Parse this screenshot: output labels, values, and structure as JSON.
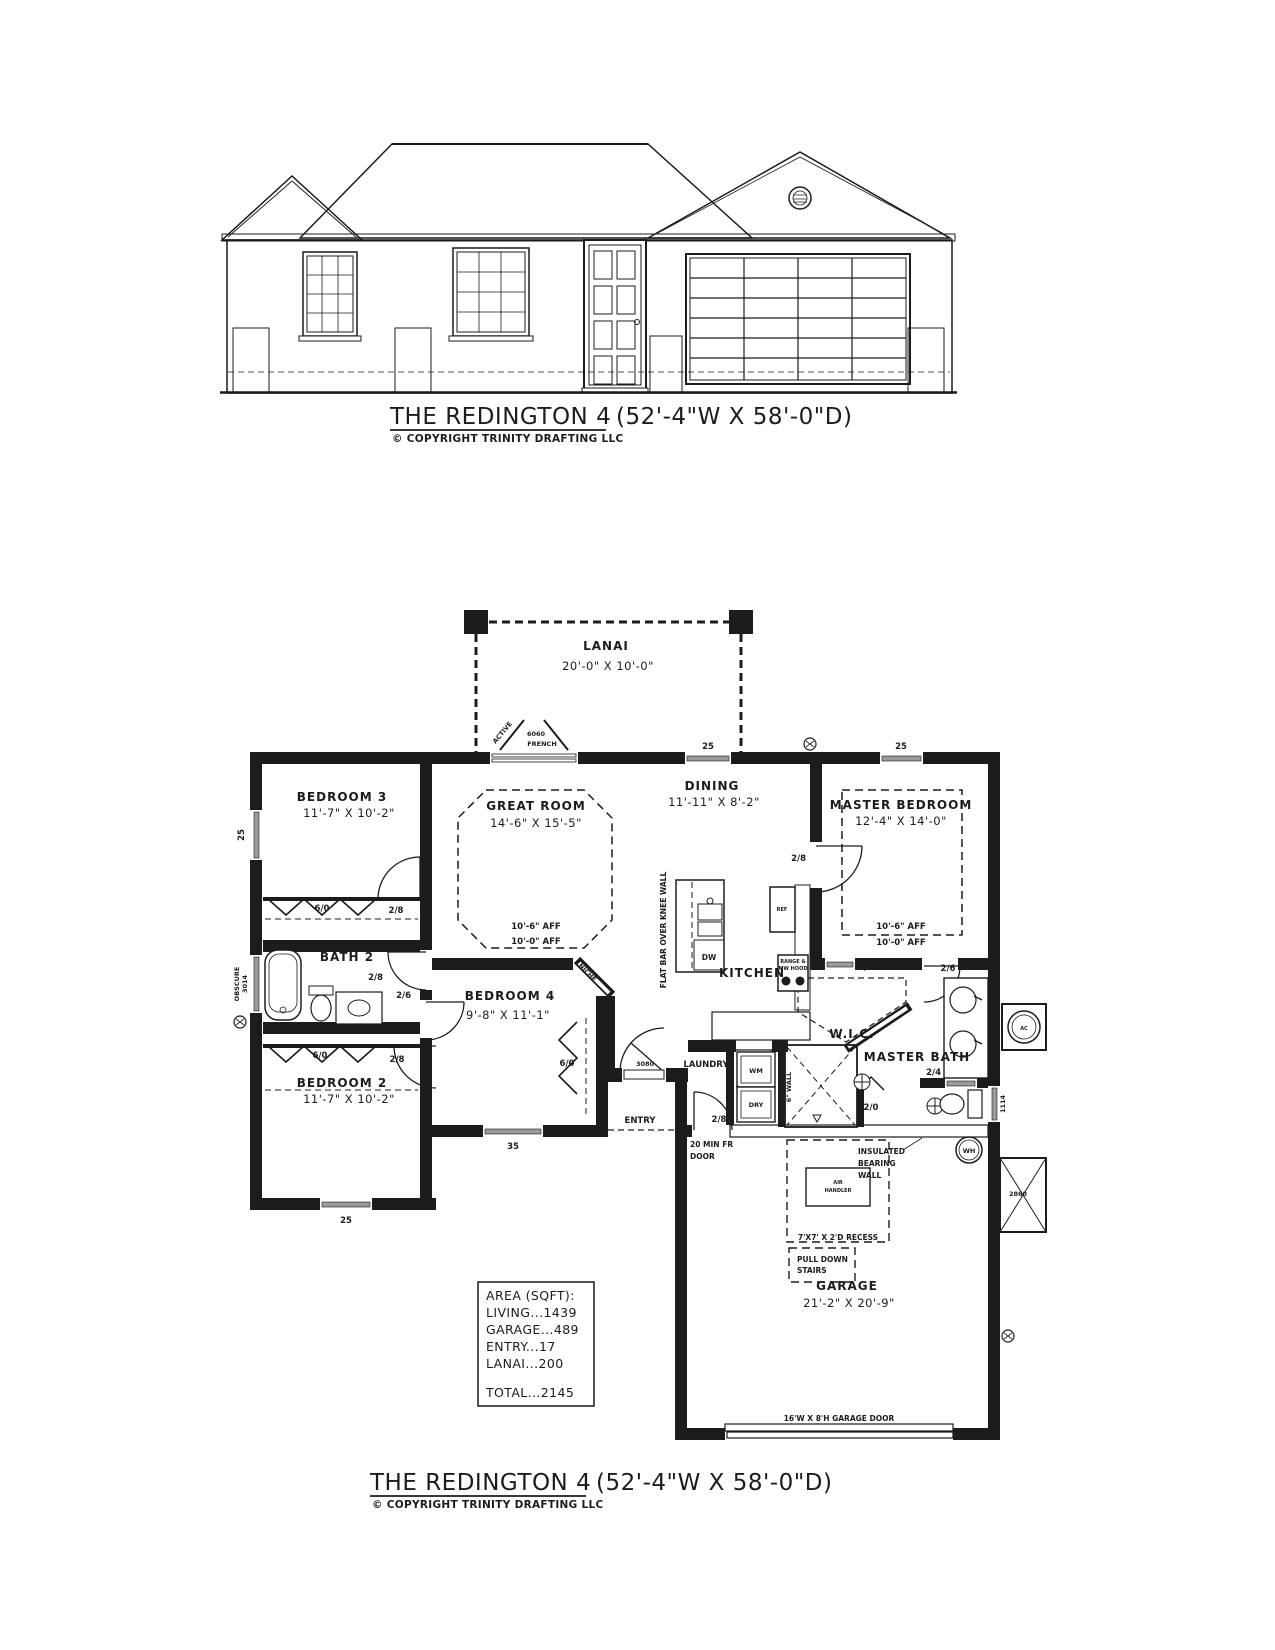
{
  "document": {
    "top_title": "THE REDINGTON 4",
    "top_title_dims": "(52'-4\"W X 58'-0\"D)",
    "bottom_title": "THE REDINGTON 4",
    "bottom_title_dims": "(52'-4\"W X 58'-0\"D)",
    "copyright": "© COPYRIGHT TRINITY DRAFTING LLC"
  },
  "rooms": {
    "lanai": {
      "name": "LANAI",
      "dims": "20'-0\" X 10'-0\""
    },
    "great_room": {
      "name": "GREAT ROOM",
      "dims": "14'-6\" X 15'-5\""
    },
    "dining": {
      "name": "DINING",
      "dims": "11'-11\" X 8'-2\""
    },
    "master_bedroom": {
      "name": "MASTER BEDROOM",
      "dims": "12'-4\" X 14'-0\""
    },
    "bedroom3": {
      "name": "BEDROOM 3",
      "dims": "11'-7\" X 10'-2\""
    },
    "bedroom2": {
      "name": "BEDROOM 2",
      "dims": "11'-7\" X 10'-2\""
    },
    "bedroom4": {
      "name": "BEDROOM 4",
      "dims": "9'-8\" X 11'-1\""
    },
    "kitchen": {
      "name": "KITCHEN"
    },
    "bath2": {
      "name": "BATH 2"
    },
    "laundry": {
      "name": "LAUNDRY"
    },
    "wic": {
      "name": "W.I.C."
    },
    "master_bath": {
      "name": "MASTER BATH"
    },
    "entry": {
      "name": "ENTRY"
    },
    "garage": {
      "name": "GARAGE",
      "dims": "21'-2\" X 20'-9\""
    }
  },
  "ceiling": {
    "aff_upper": "10'-6\" AFF",
    "aff_lower": "10'-0\" AFF"
  },
  "labels": {
    "active": "ACTIVE",
    "french_size": "6060",
    "french": "FRENCH",
    "win_25": "25",
    "win_35": "35",
    "win_2860": "2860",
    "win_1114": "1114",
    "win_obscure": "OBSCURE",
    "win_3014": "3014",
    "door_28": "2/8",
    "door_26": "2/6",
    "door_24": "2/4",
    "door_20": "2/0",
    "door_3080": "3080",
    "closet_60": "6/0",
    "niche": "NICHE",
    "flat_bar": "FLAT BAR OVER KNEE WALL",
    "six_wall": "6\" WALL",
    "fire_door_line1": "20 MIN FR",
    "fire_door_line2": "DOOR",
    "insulated_line1": "INSULATED",
    "insulated_line2": "BEARING",
    "insulated_line3": "WALL",
    "recess": "7'X7' X 2'D RECESS",
    "pull_down_line1": "PULL DOWN",
    "pull_down_line2": "STAIRS",
    "garage_door": "16'W X 8'H GARAGE DOOR"
  },
  "fixtures": {
    "ref": "REF",
    "dw": "DW",
    "range_line1": "RANGE &",
    "range_line2": "MW HOOD",
    "wm": "WM",
    "dry": "DRY",
    "wh": "WH",
    "ac": "AC",
    "air_handler_line1": "AIR",
    "air_handler_line2": "HANDLER"
  },
  "area_table": {
    "header": "AREA (SQFT):",
    "rows": [
      "LIVING...1439",
      "GARAGE...489",
      "ENTRY...17",
      "LANAI...200"
    ],
    "total": "TOTAL...2145"
  },
  "colors": {
    "ink": "#1c1c1c",
    "window_sill": "#9b9b9b",
    "paper": "#ffffff"
  }
}
